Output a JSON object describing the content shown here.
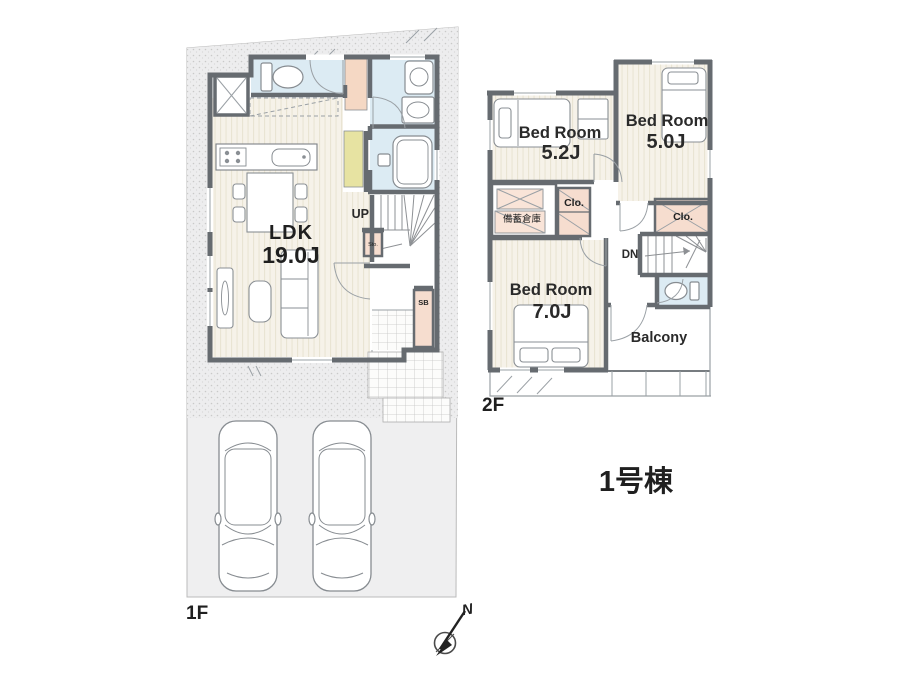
{
  "building": {
    "name_label": "1号棟"
  },
  "floor1": {
    "label": "1F",
    "ldk_name": "LDK",
    "ldk_size": "19.0J",
    "stairs_label": "UP",
    "shoe_box_label": "SB",
    "storage_label": "Sto."
  },
  "floor2": {
    "label": "2F",
    "bedroom1_name": "Bed Room",
    "bedroom1_size": "5.2J",
    "bedroom2_name": "Bed Room",
    "bedroom2_size": "5.0J",
    "bedroom3_name": "Bed Room",
    "bedroom3_size": "7.0J",
    "storage_label": "備蓄倉庫",
    "closet1_label": "Clo.",
    "closet2_label": "Clo.",
    "stairs_label": "DN",
    "balcony_label": "Balcony"
  },
  "compass": {
    "north_label": "N"
  },
  "colors": {
    "wall": "#666b70",
    "site": "#efeff0",
    "wet_area": "#dcebf3",
    "closet": "#f6ddcf",
    "accent_peach": "#f5d8c4",
    "accent_yellow": "#e7e3a2",
    "floor_stripe": "#f6f2e9",
    "text": "#1f1f1f"
  }
}
